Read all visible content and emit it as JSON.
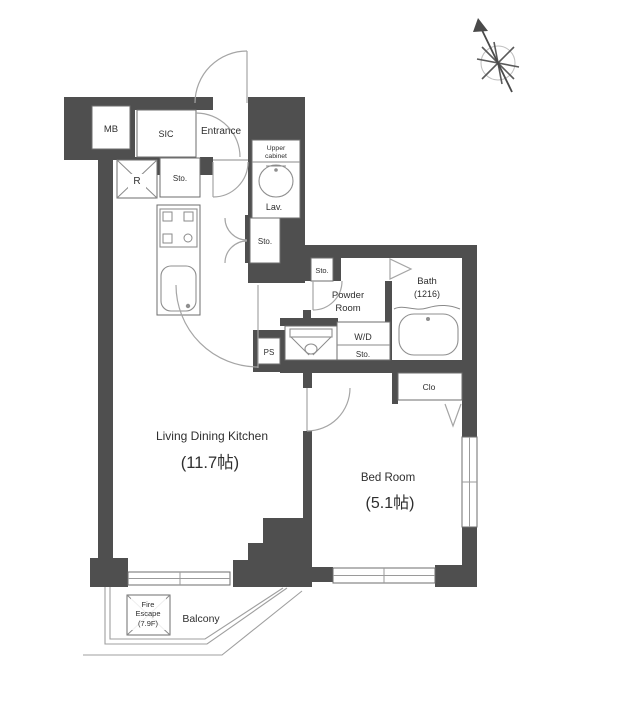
{
  "plan": {
    "meter_box": {
      "label": "MB"
    },
    "shoe_closet": {
      "label": "SIC"
    },
    "entrance": {
      "label": "Entrance"
    },
    "upper_cabinet": {
      "line1": "Upper",
      "line2": "cabinet"
    },
    "lavatory": {
      "label": "Lav."
    },
    "refrigerator": {
      "label": "R"
    },
    "storage_hall": {
      "label": "Sto."
    },
    "storage_corridor": {
      "label": "Sto."
    },
    "storage_powder": {
      "label": "Sto."
    },
    "powder_room": {
      "line1": "Powder",
      "line2": "Room"
    },
    "bath": {
      "label": "Bath",
      "size": "(1216)"
    },
    "washer_dryer": {
      "label": "W/D",
      "storage_label": "Sto."
    },
    "pipe_space": {
      "label": "PS"
    },
    "closet": {
      "label": "Clo"
    },
    "living_dining_kitchen": {
      "label": "Living Dining Kitchen",
      "size": "(11.7帖)"
    },
    "bedroom": {
      "label": "Bed Room",
      "size": "(5.1帖)"
    },
    "fire_escape": {
      "line1": "Fire",
      "line2": "Escape",
      "line3": "(7.9F)"
    },
    "balcony": {
      "label": "Balcony"
    }
  },
  "colors": {
    "wall": "#4f4f4f",
    "line": "#8a8a8a",
    "text": "#2f2f2f",
    "background": "#ffffff"
  }
}
